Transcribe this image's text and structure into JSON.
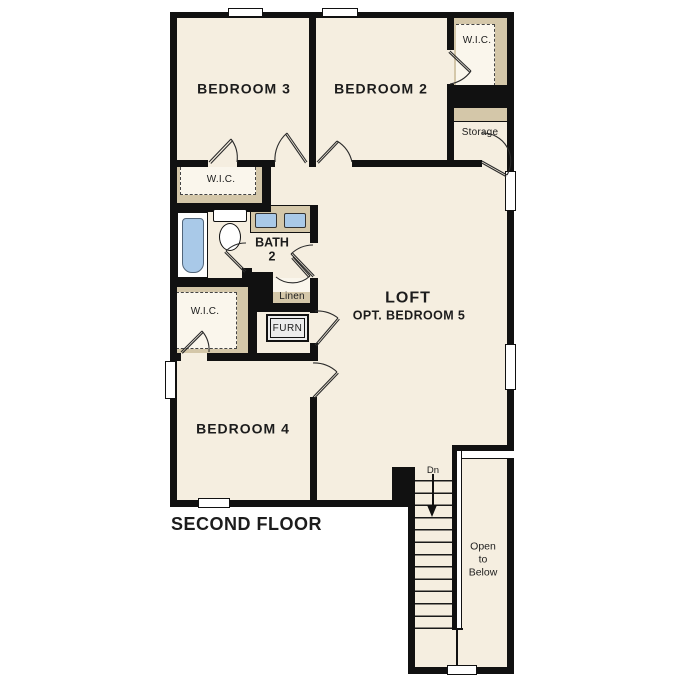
{
  "plan": {
    "title": "SECOND FLOOR",
    "rooms": {
      "bedroom3": "BEDROOM 3",
      "bedroom2": "BEDROOM 2",
      "bedroom4": "BEDROOM 4",
      "loft_line1": "LOFT",
      "loft_line2": "OPT. BEDROOM 5",
      "bath_line1": "BATH",
      "bath_line2": "2",
      "wic_top": "W.I.C.",
      "wic_mid": "W.I.C.",
      "wic_left": "W.I.C.",
      "storage": "Storage",
      "linen": "Linen",
      "furnace": "FURN"
    },
    "stairs": {
      "down_label": "Dn",
      "open_line1": "Open",
      "open_line2": "to",
      "open_line3": "Below"
    },
    "colors": {
      "floor": "#f5eee0",
      "closet_tan": "#d4c7a9",
      "wall": "#111111",
      "fixture_blue": "#a9c9e8",
      "window_white": "#ffffff"
    }
  }
}
